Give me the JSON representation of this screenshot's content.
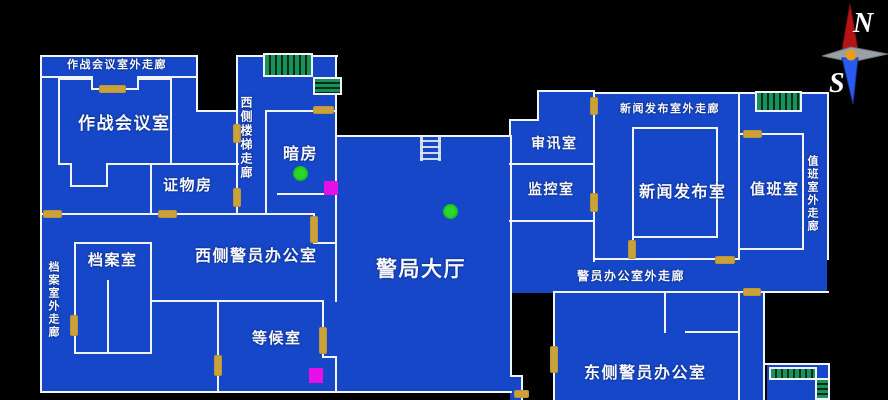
{
  "map_labels": {
    "ops_corridor": "作战会议室外走廊",
    "ops_room": "作战会议室",
    "evidence_room": "证物房",
    "west_stairs_corridor": "西侧楼梯走廊",
    "darkroom": "暗房",
    "archive_corridor": "档案室外走廊",
    "archive_room": "档案室",
    "west_office": "西侧警员办公室",
    "waiting_room": "等候室",
    "main_hall": "警局大厅",
    "interrogation_room": "审讯室",
    "monitor_room": "监控室",
    "press_corridor": "新闻发布室外走廊",
    "press_room": "新闻发布室",
    "duty_room": "值班室",
    "duty_corridor": "值班室外走廊",
    "officer_corridor": "警员办公室外走廊",
    "east_office": "东侧警员办公室"
  },
  "compass": {
    "north": "N",
    "south": "S"
  },
  "colors": {
    "background": "#000000",
    "floor_blue": "#1547c8",
    "wall_white": "#f2f4f8",
    "door_tan": "#c9a23c",
    "stairs_green": "#16925c",
    "item_dot_green": "#2bd92b",
    "marker_magenta": "#e60fe6",
    "compass_north_red": "#b51414",
    "compass_south_blue": "#2a5bf0",
    "compass_center_orange": "#e89c20"
  }
}
